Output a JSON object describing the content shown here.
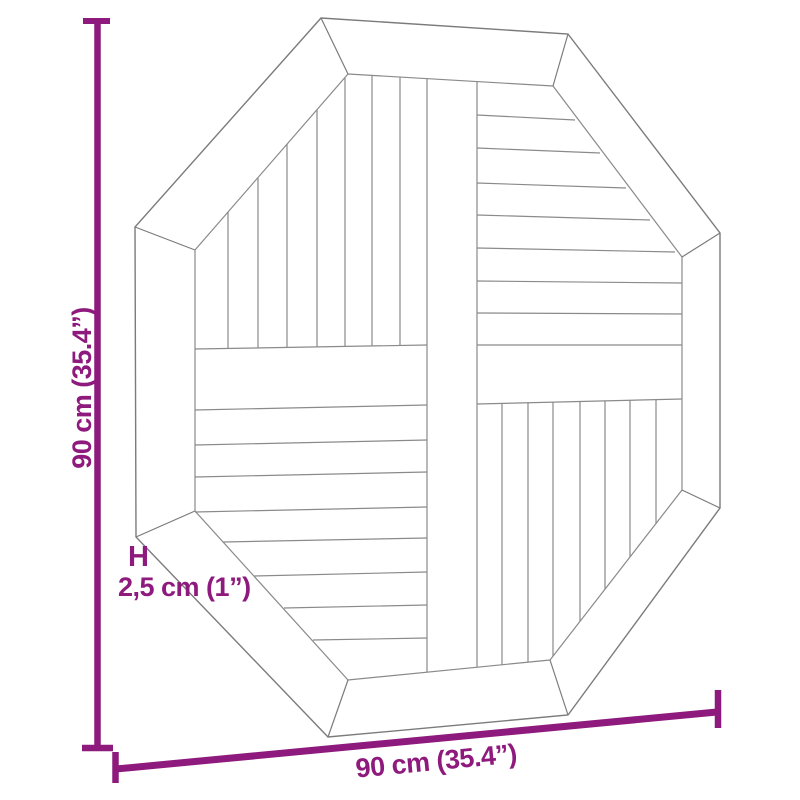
{
  "accent_color": "#8e1a7d",
  "labels": {
    "height": "90 cm (35.4”)",
    "width": "90 cm (35.4”)",
    "thickness_prefix": "H",
    "thickness": "2,5 cm (1”)"
  },
  "diagram": {
    "background": "#ffffff",
    "outline_color": "#7b7b7b",
    "plank_color": "#8a8a8a",
    "outline_width": 1.4,
    "plank_width": 1.2,
    "outer_octagon": [
      [
        321,
        18
      ],
      [
        568,
        34
      ],
      [
        720,
        233
      ],
      [
        720,
        508
      ],
      [
        568,
        715
      ],
      [
        328,
        737
      ],
      [
        136,
        537
      ],
      [
        135,
        227
      ]
    ],
    "inner_octagon": [
      [
        348,
        74
      ],
      [
        553,
        86
      ],
      [
        682,
        257
      ],
      [
        682,
        490
      ],
      [
        550,
        660
      ],
      [
        348,
        680
      ],
      [
        195,
        511
      ],
      [
        195,
        250
      ]
    ],
    "miter_lines": [
      [
        321,
        18,
        348,
        74
      ],
      [
        568,
        34,
        553,
        86
      ],
      [
        720,
        233,
        682,
        257
      ],
      [
        720,
        508,
        682,
        490
      ],
      [
        568,
        715,
        550,
        660
      ],
      [
        328,
        737,
        348,
        680
      ],
      [
        136,
        537,
        195,
        511
      ],
      [
        135,
        227,
        195,
        250
      ]
    ],
    "plank_lines": [
      [
        427,
        79,
        427,
        672
      ],
      [
        477,
        82,
        477,
        667
      ],
      [
        195,
        349,
        427,
        345
      ],
      [
        477,
        404,
        682,
        399
      ],
      [
        228,
        212,
        228,
        348
      ],
      [
        258,
        178,
        258,
        348
      ],
      [
        287,
        144,
        287,
        347
      ],
      [
        317,
        110,
        317,
        347
      ],
      [
        345,
        78,
        345,
        346
      ],
      [
        372,
        75,
        372,
        346
      ],
      [
        400,
        77,
        400,
        346
      ],
      [
        195,
        410,
        427,
        405
      ],
      [
        195,
        445,
        427,
        440
      ],
      [
        195,
        477,
        427,
        472
      ],
      [
        195,
        512,
        427,
        507
      ],
      [
        223,
        542,
        427,
        538
      ],
      [
        254,
        576,
        427,
        572
      ],
      [
        284,
        608,
        427,
        605
      ],
      [
        313,
        640,
        427,
        638
      ],
      [
        477,
        115,
        575,
        120
      ],
      [
        477,
        148,
        600,
        153
      ],
      [
        477,
        183,
        626,
        188
      ],
      [
        477,
        215,
        650,
        220
      ],
      [
        477,
        248,
        675,
        252
      ],
      [
        477,
        281,
        682,
        283
      ],
      [
        477,
        313,
        682,
        314
      ],
      [
        477,
        345,
        682,
        345
      ],
      [
        502,
        403,
        502,
        665
      ],
      [
        528,
        403,
        528,
        662
      ],
      [
        553,
        402,
        553,
        656
      ],
      [
        580,
        402,
        580,
        621
      ],
      [
        605,
        401,
        605,
        589
      ],
      [
        630,
        400,
        630,
        557
      ],
      [
        656,
        400,
        656,
        524
      ]
    ],
    "dimension_lines": [
      {
        "x1": 97.5,
        "y1": 21,
        "x2": 97.5,
        "y2": 745,
        "w": 6.5
      },
      {
        "x1": 83,
        "y1": 21,
        "x2": 110,
        "y2": 21,
        "w": 6
      },
      {
        "x1": 82,
        "y1": 748,
        "x2": 113,
        "y2": 748,
        "w": 6.5
      },
      {
        "x1": 116,
        "y1": 769,
        "x2": 717,
        "y2": 712,
        "w": 7
      },
      {
        "x1": 115.5,
        "y1": 752,
        "x2": 115.5,
        "y2": 783,
        "w": 6.5
      },
      {
        "x1": 718,
        "y1": 690,
        "x2": 718,
        "y2": 728,
        "w": 6.5
      }
    ]
  }
}
